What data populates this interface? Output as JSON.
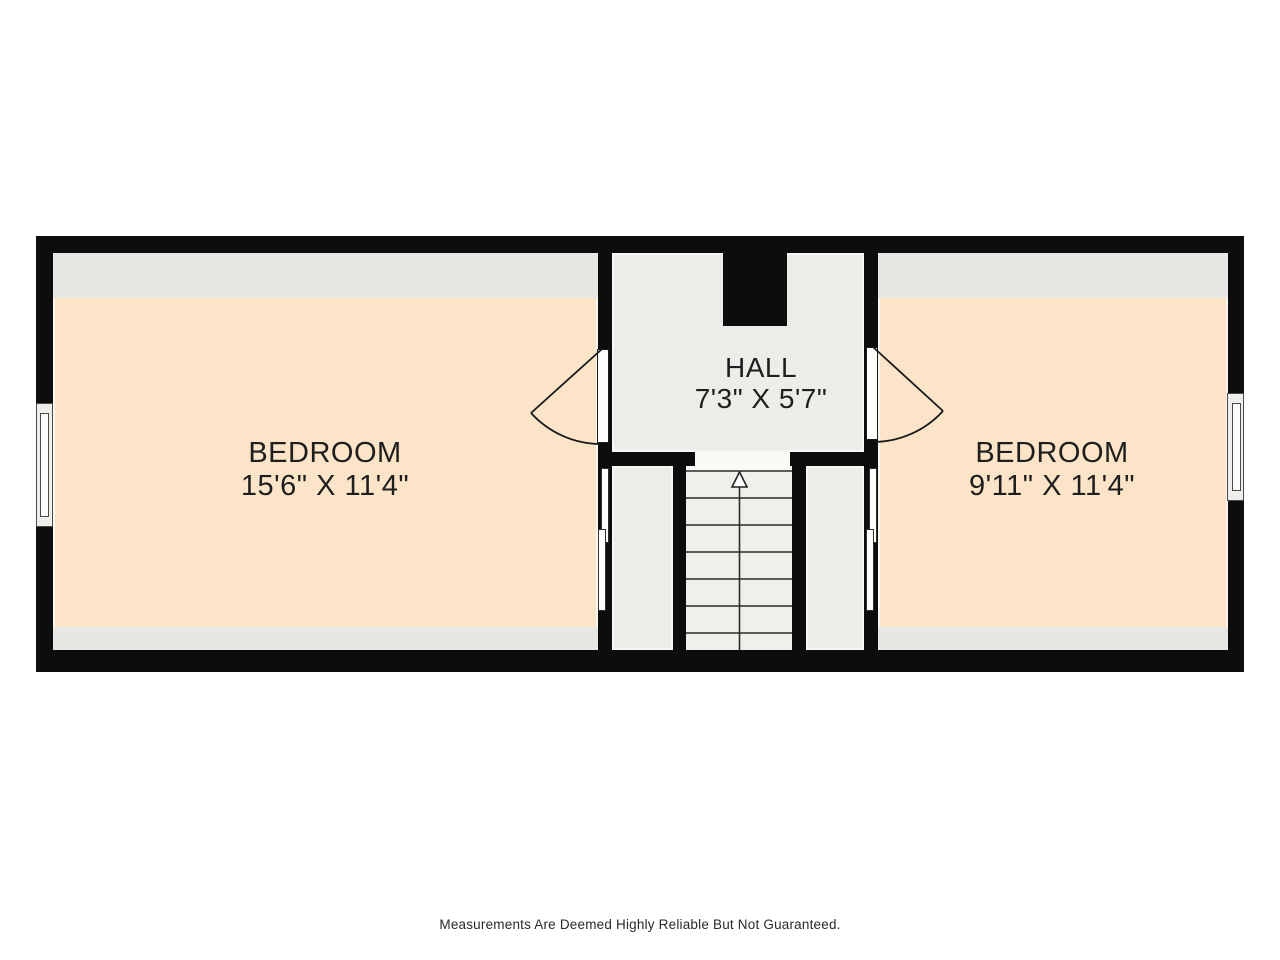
{
  "footer": {
    "disclaimer": "Measurements Are Deemed Highly Reliable But Not Guaranteed."
  },
  "rooms": {
    "bedroom_left": {
      "name": "BEDROOM",
      "dims": "15'6\" X 11'4\""
    },
    "hall": {
      "name": "HALL",
      "dims": "7'3\" X 5'7\""
    },
    "bedroom_right": {
      "name": "BEDROOM",
      "dims": "9'11\" X 11'4\""
    }
  },
  "stairs": {
    "direction": "up",
    "tread_count": 7
  },
  "fixtures": {
    "windows": [
      "left-exterior-window",
      "right-exterior-window"
    ],
    "doors": [
      "bedroom-left-hinged-door",
      "bedroom-right-hinged-door",
      "closet-left-sliding-doors",
      "closet-right-sliding-doors"
    ]
  },
  "colors": {
    "wall": "#0d0d0d",
    "bedroomFloor": "#fce4c8",
    "ceilingBand": "#e9e7e3",
    "hallFloor": "#eeece9",
    "stairFloor": "#f1efec",
    "landing": "#faf9f6",
    "fixture": "#fdfdfc",
    "line": "#222222",
    "text": "#1e1e1e",
    "page": "#ffffff"
  }
}
